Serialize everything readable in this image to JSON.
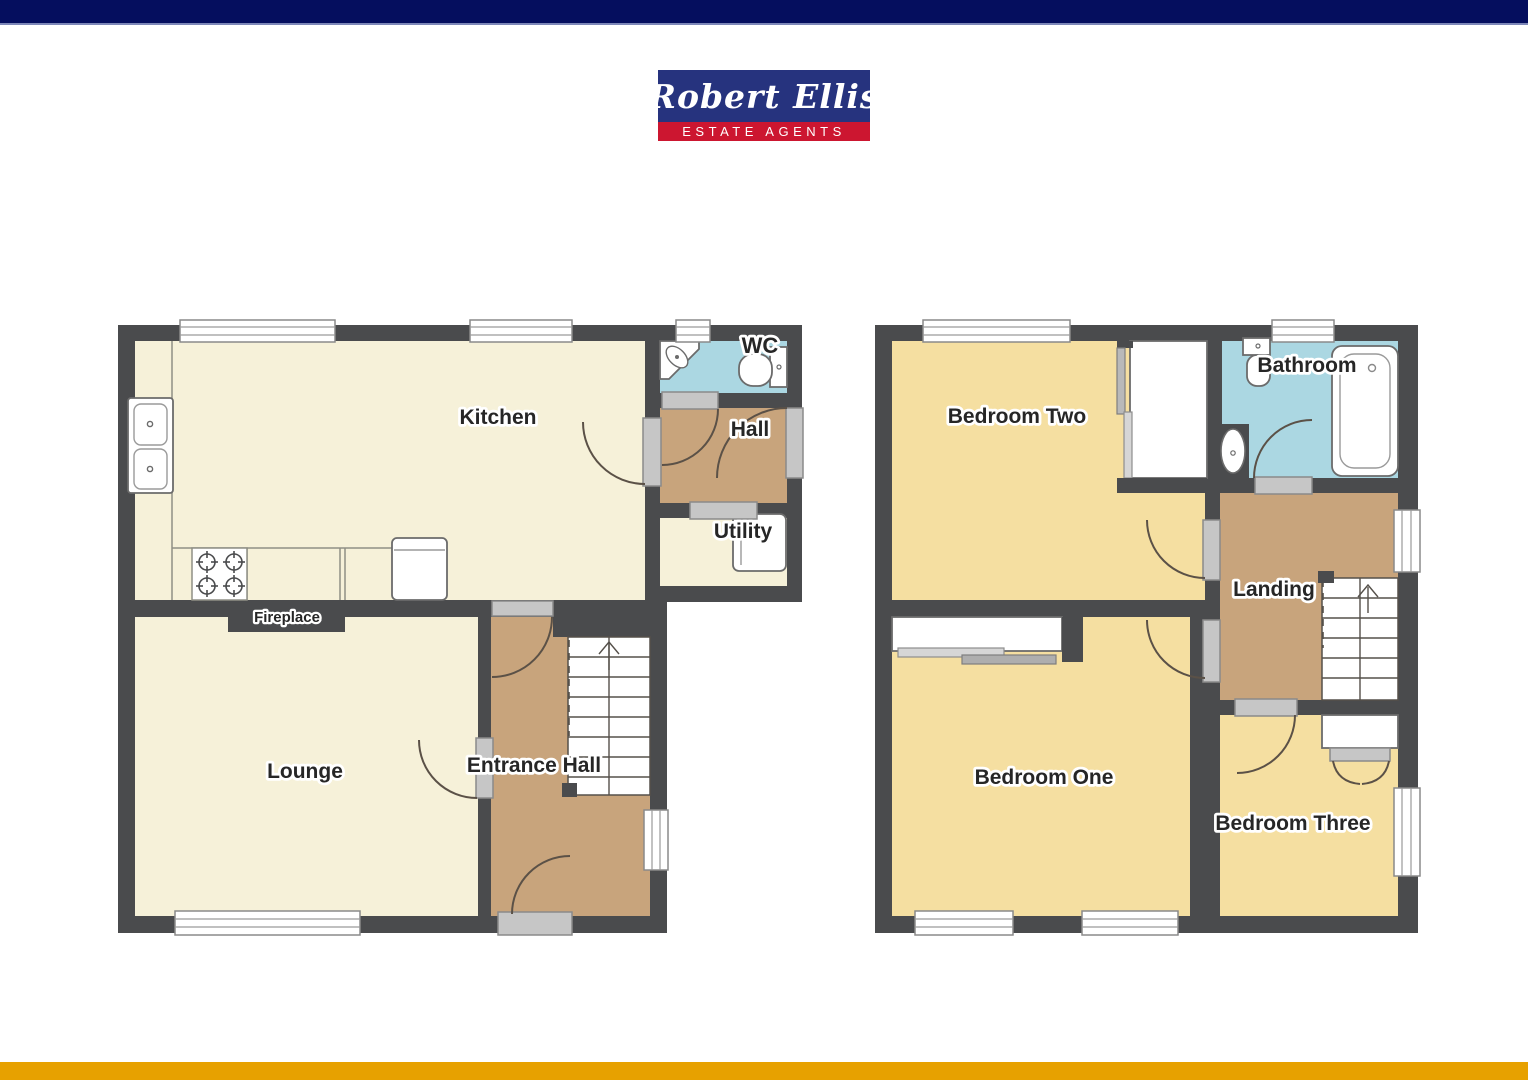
{
  "header": {
    "top_bar_color": "#050e5e"
  },
  "footer": {
    "bottom_bar_color": "#e7a100"
  },
  "brand": {
    "name": "Robert Ellis",
    "tagline": "ESTATE AGENTS",
    "logo_bg": "#26337e",
    "tagline_bg": "#cc1630"
  },
  "ground_floor": {
    "rooms": {
      "kitchen": "Kitchen",
      "wc": "WC",
      "hall": "Hall",
      "utility": "Utility",
      "lounge": "Lounge",
      "entrance_hall": "Entrance Hall"
    },
    "features": {
      "fireplace": "Fireplace"
    }
  },
  "first_floor": {
    "rooms": {
      "bedroom_two": "Bedroom Two",
      "bathroom": "Bathroom",
      "landing": "Landing",
      "bedroom_one": "Bedroom One",
      "bedroom_three": "Bedroom Three"
    }
  },
  "palette": {
    "wall": "#4a4b4d",
    "room_cream": "#f6f1d9",
    "room_yellow": "#f5dfa1",
    "room_tan": "#c8a47c",
    "room_blue": "#abd7e2",
    "door_gray": "#c6c6c6"
  }
}
